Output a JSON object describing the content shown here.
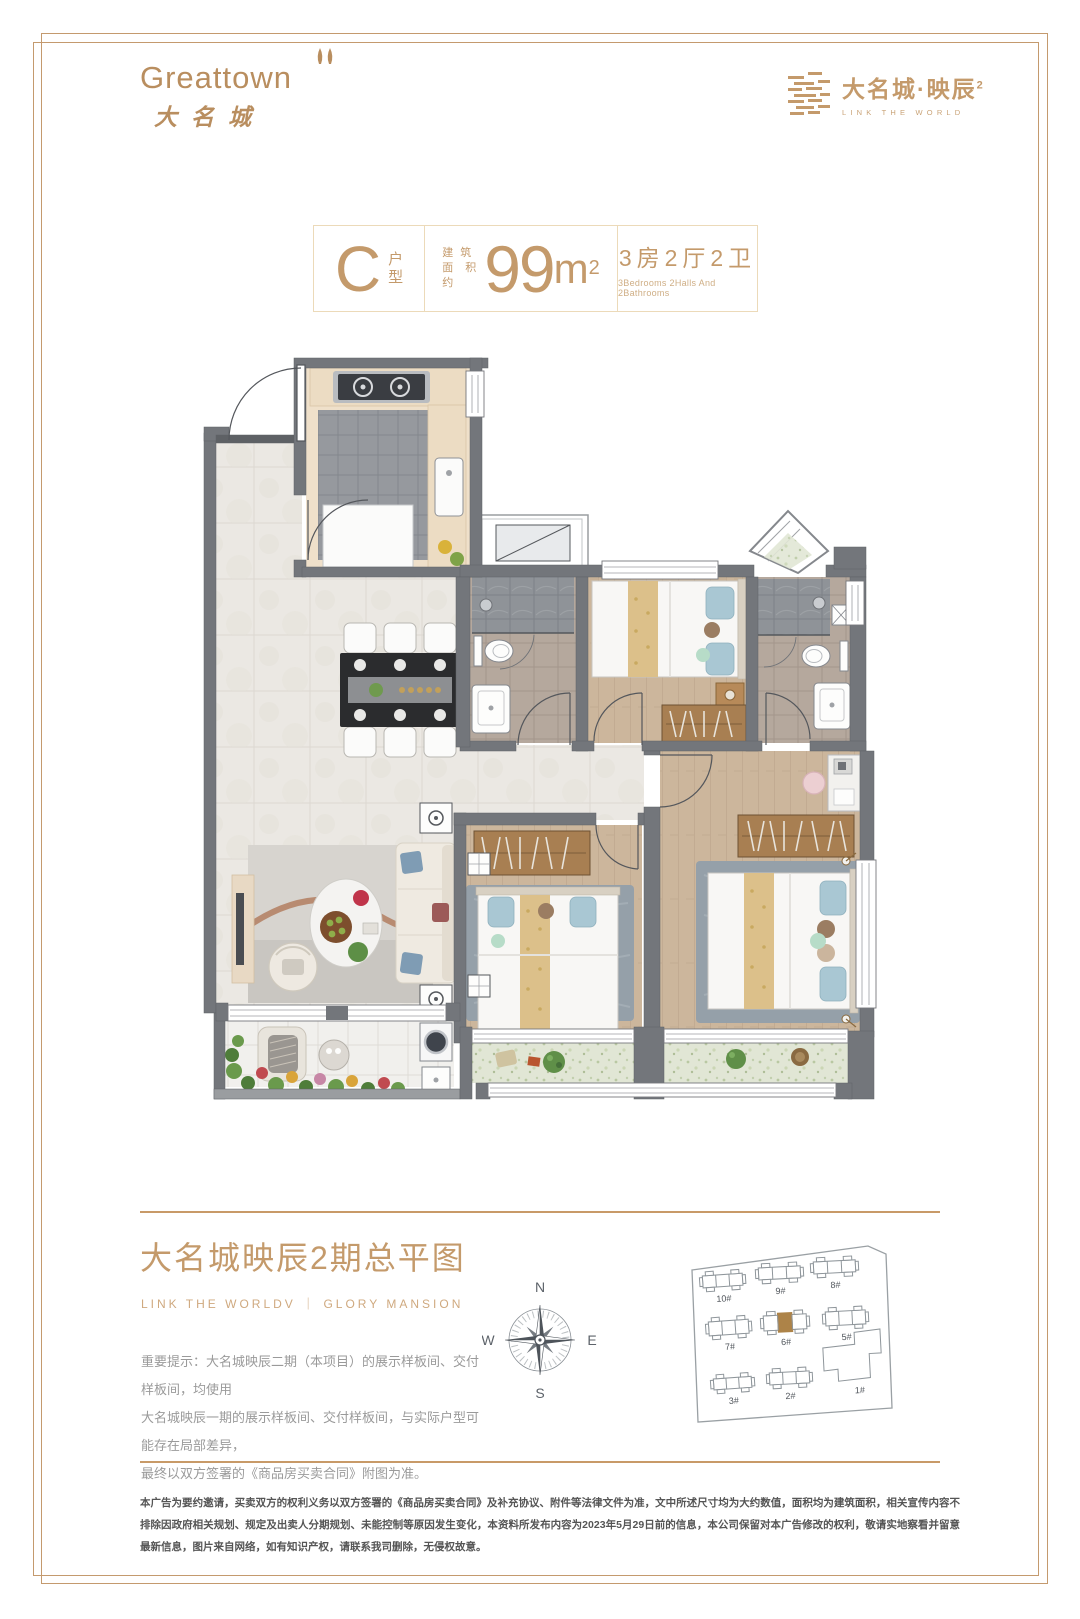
{
  "brand": {
    "logo_left_latin": "Greattown",
    "logo_left_cjk": "大名城",
    "logo_right_name": "大名城·映辰",
    "logo_right_sup": "2",
    "logo_right_tagline": "LINK THE WORLD",
    "accent_color": "#c49a6b"
  },
  "unit_card": {
    "unit_letter": "C",
    "unit_label_1": "户",
    "unit_label_2": "型",
    "area_prefix_line1": "建 筑",
    "area_prefix_line2": "面积约",
    "area_value": "99",
    "area_unit": "m",
    "area_sup": "2",
    "layout_cn": "3房2厅2卫",
    "layout_en": "3Bedrooms 2Halls And 2Bathrooms"
  },
  "site_section": {
    "title": "大名城映辰2期总平图",
    "subtitle": "LINK THE WORLDV ｜ GLORY MANSION",
    "notice_lines": [
      "重要提示：大名城映辰二期（本项目）的展示样板间、交付样板间，均使用",
      "大名城映辰一期的展示样板间、交付样板间，与实际户型可能存在局部差异，",
      "最终以双方签署的《商品房买卖合同》附图为准。"
    ],
    "compass": {
      "n": "N",
      "e": "E",
      "s": "S",
      "w": "W"
    }
  },
  "site_map": {
    "boundary_points": "20,38 196,14 214,22 220,176 26,190",
    "highlight_color": "#ad8348",
    "outline_color": "#8f969b",
    "buildings": [
      {
        "label": "10#",
        "x": 30,
        "y": 40,
        "w": 40,
        "h": 20,
        "rot": -4,
        "type": "std",
        "highlight": false
      },
      {
        "label": "9#",
        "x": 86,
        "y": 32,
        "w": 42,
        "h": 20,
        "rot": -3,
        "type": "std",
        "highlight": false
      },
      {
        "label": "8#",
        "x": 141,
        "y": 26,
        "w": 42,
        "h": 20,
        "rot": -3,
        "type": "std",
        "highlight": false
      },
      {
        "label": "7#",
        "x": 36,
        "y": 86,
        "w": 40,
        "h": 22,
        "rot": -4,
        "type": "std",
        "highlight": false
      },
      {
        "label": "6#",
        "x": 91,
        "y": 80,
        "w": 43,
        "h": 23,
        "rot": -3,
        "type": "std",
        "highlight": true
      },
      {
        "label": "5#",
        "x": 153,
        "y": 76,
        "w": 40,
        "h": 22,
        "rot": -3,
        "type": "std",
        "highlight": false
      },
      {
        "label": "3#",
        "x": 41,
        "y": 143,
        "w": 38,
        "h": 19,
        "rot": -4,
        "type": "std",
        "highlight": false
      },
      {
        "label": "2#",
        "x": 97,
        "y": 137,
        "w": 40,
        "h": 20,
        "rot": -3,
        "type": "std",
        "highlight": false
      },
      {
        "label": "1#",
        "x": 150,
        "y": 100,
        "w": 58,
        "h": 52,
        "rot": -3,
        "type": "large",
        "highlight": false
      }
    ]
  },
  "disclaimer_lines": [
    "本广告为要约邀请，买卖双方的权利义务以双方签署的《商品房买卖合同》及补充协议、附件等法律文件为准，文中所述尺寸均为大约数值，面积均为建筑面积，相关宣传内容不排除因政府相关规划、规定及出卖人分期规划、未能控制",
    "等原因发生变化，本资料所发布内容为2023年5月29日前的信息，本公司保留对本广告修改的权利，敬请实地察看并留意最新信息，图片来自网络，如有知识产权，请联系我司删除，无侵权故意。"
  ]
}
